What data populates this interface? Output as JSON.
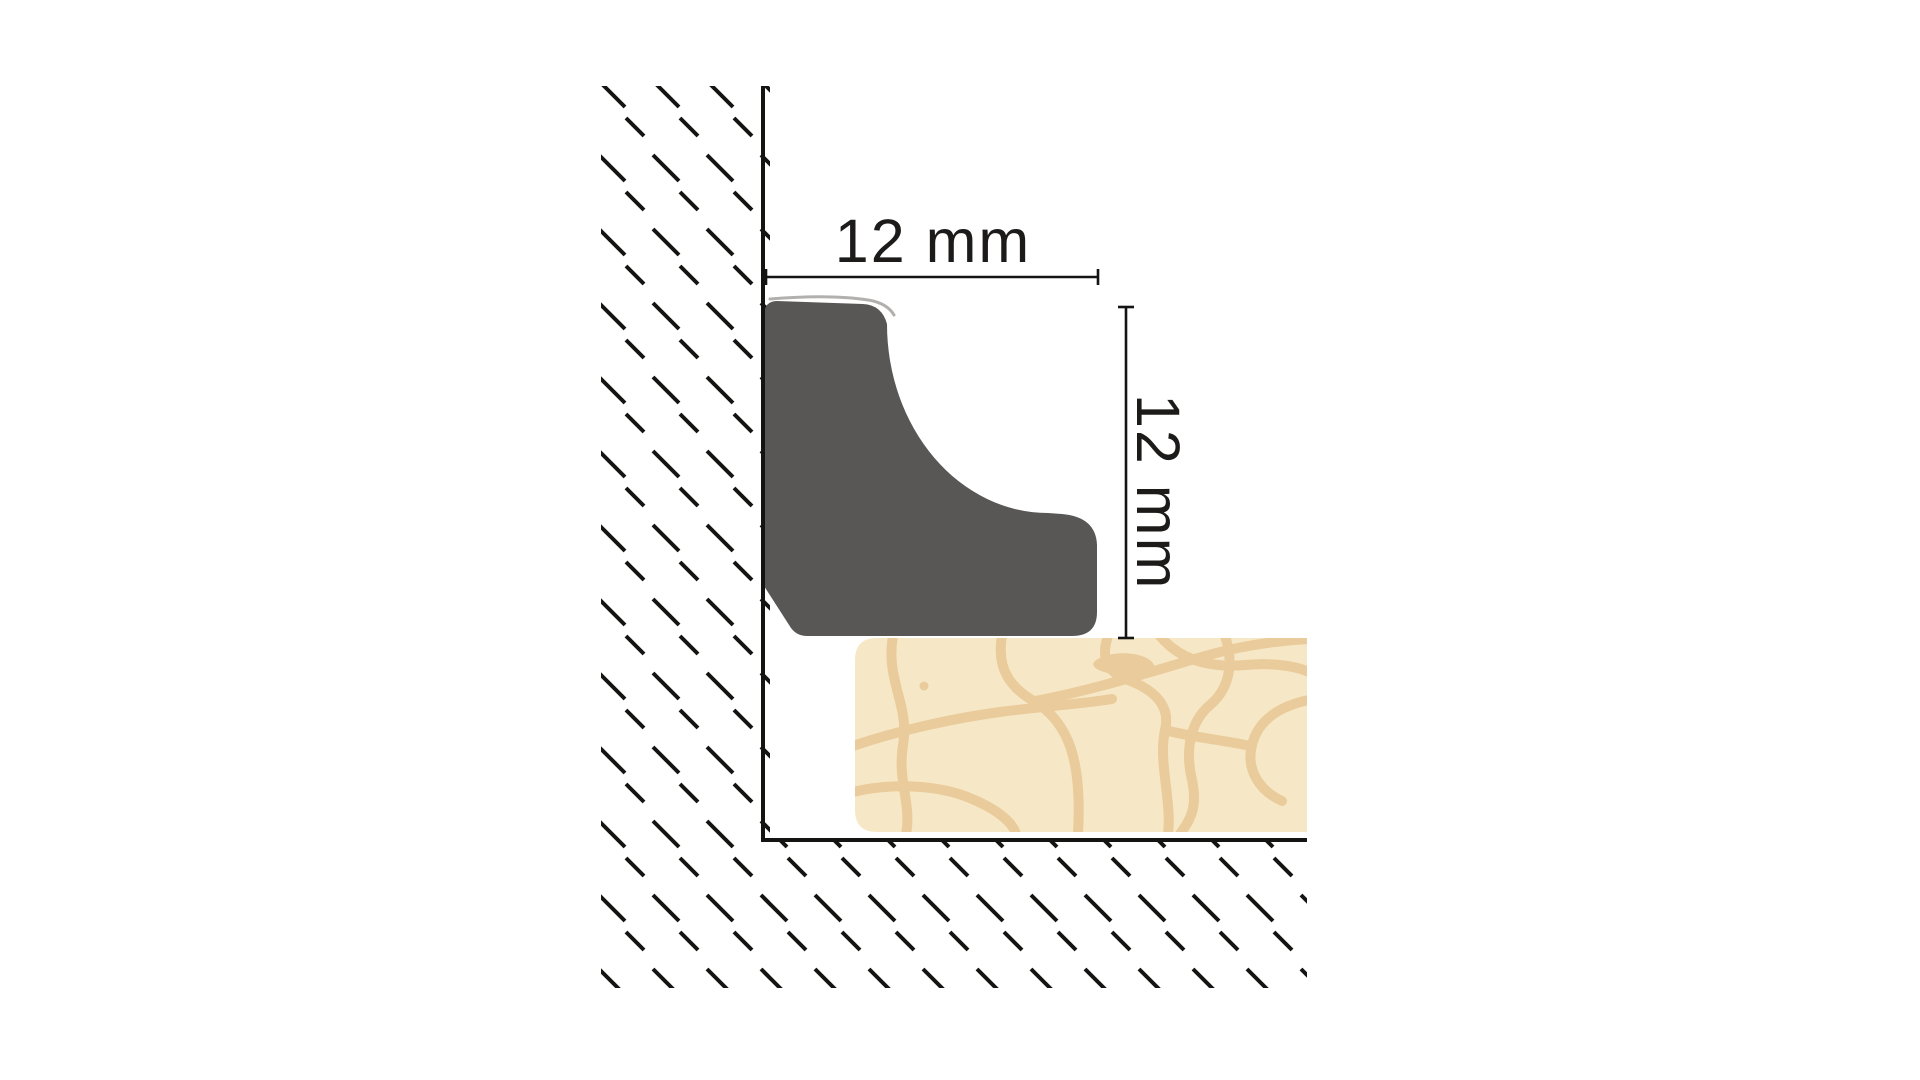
{
  "diagram": {
    "type": "installation-cross-section",
    "subject": "cove-quarter-round-skirting-profile-covering-floor-expansion-gap",
    "dimensions": {
      "width": {
        "label": "12 mm"
      },
      "height": {
        "label": "12 mm"
      }
    },
    "parts": {
      "wall_hatch": "masonry-hatch-band-left",
      "wall_line": "wall-surface-line",
      "profile": "cove-profile-cross-section",
      "floor_board": "laminate-floor-board",
      "subfloor_line": "subfloor-surface-line",
      "subfloor_hatch": "masonry-hatch-band-bottom"
    },
    "colors": {
      "background": "#ffffff",
      "line": "#141413",
      "profile": "#595756",
      "profile_highlight": "#b2b0ae",
      "floor": "#f6e8c6",
      "floor_crack": "#eacb9b"
    }
  }
}
